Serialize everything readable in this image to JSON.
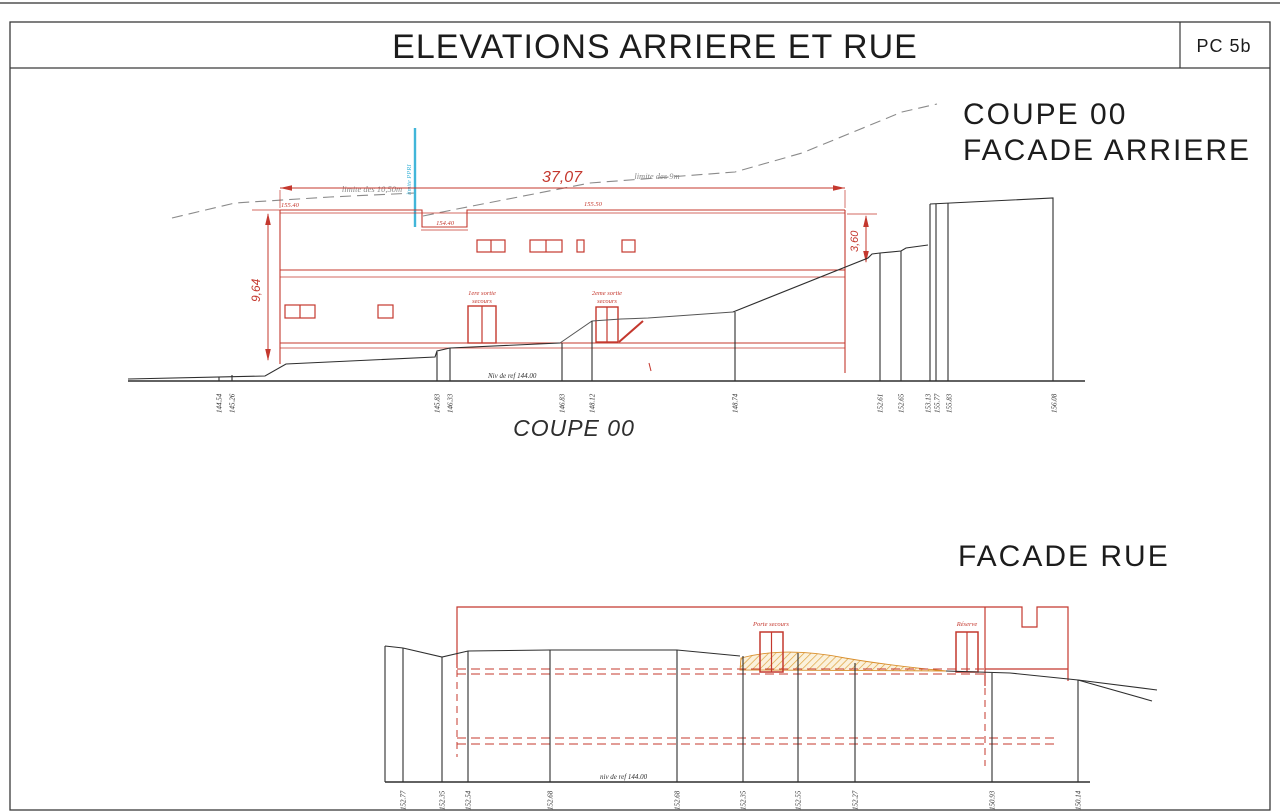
{
  "sheet": {
    "title": "ELEVATIONS ARRIERE ET RUE",
    "ref": "PC 5b"
  },
  "coupe": {
    "heading1": "COUPE 00",
    "heading2": "FACADE ARRIERE",
    "caption": "COUPE 00",
    "dims": {
      "width": "37,07",
      "height_left": "9,64",
      "height_right": "3,60"
    },
    "levels": {
      "top_left": "155.40",
      "notch": "154.40",
      "top_right": "155.50",
      "ref": "Niv de ref 144.00"
    },
    "limits": {
      "l1050": "limite des 10,50m",
      "l9": "limite des 9m",
      "ppri": "limite PPRI"
    },
    "doors": {
      "d1a": "1ere sortie",
      "d1b": "secours",
      "d2a": "2eme sortie",
      "d2b": "secours"
    },
    "ground_labels": [
      "144.54",
      "145.26",
      "145.83",
      "146.33",
      "146.83",
      "148.12",
      "148.74",
      "152.61",
      "152.65",
      "153.13",
      "155.77",
      "155.83",
      "156.08"
    ]
  },
  "facade": {
    "heading": "FACADE RUE",
    "door1": "Porte secours",
    "door2": "Réserve",
    "ref": "niv de ref 144.00",
    "ground_labels": [
      "152.77",
      "152.35",
      "152.54",
      "152.68",
      "152.68",
      "152.35",
      "152.55",
      "152.27",
      "150.93",
      "150.14"
    ]
  },
  "colors": {
    "red": "#c4382e",
    "black": "#2e2e2e",
    "gray": "#8a8a8a",
    "cyan": "#41b6d9",
    "hatch": "#dfa33e"
  }
}
